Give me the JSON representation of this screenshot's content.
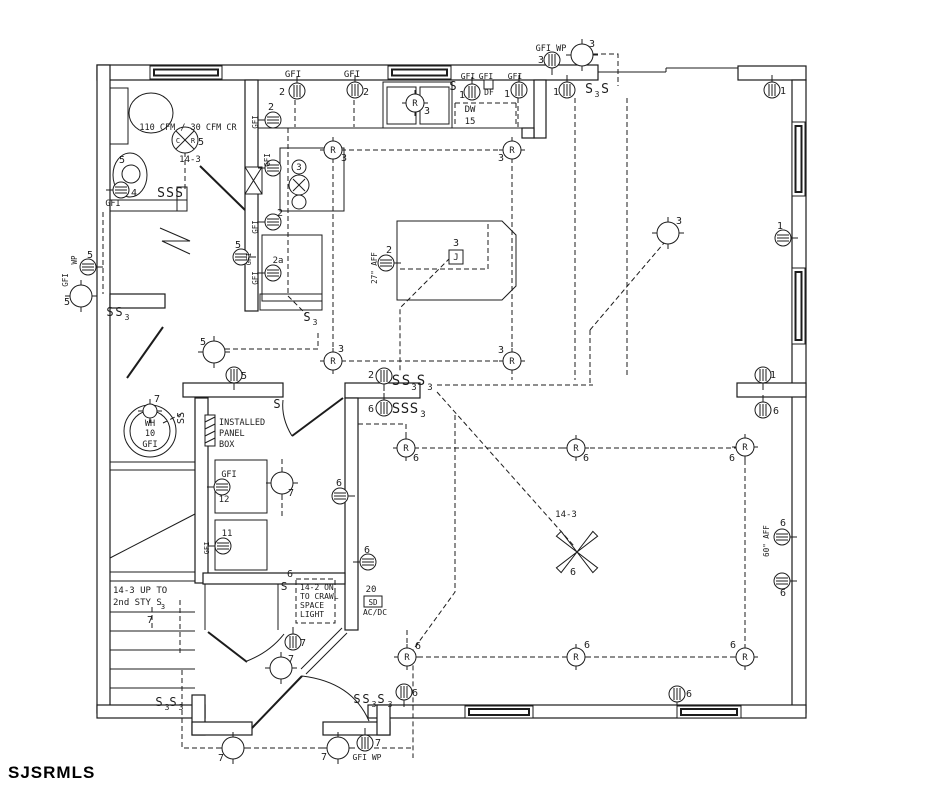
{
  "watermark": "SJSRMLS",
  "canvas": {
    "w": 939,
    "h": 788,
    "ink": "#1c1c1c",
    "bg": "#ffffff"
  },
  "plan": {
    "walls": [
      [
        97,
        65,
        501,
        15
      ],
      [
        738,
        66,
        68,
        14
      ],
      [
        792,
        80,
        14,
        633
      ],
      [
        97,
        65,
        13,
        648
      ],
      [
        97,
        705,
        108,
        13
      ],
      [
        368,
        705,
        438,
        13
      ],
      [
        192,
        695,
        13,
        40
      ],
      [
        192,
        722,
        60,
        13
      ],
      [
        323,
        722,
        67,
        13
      ],
      [
        377,
        705,
        13,
        30
      ],
      [
        245,
        80,
        13,
        231
      ],
      [
        110,
        294,
        55,
        14
      ],
      [
        183,
        383,
        100,
        14
      ],
      [
        345,
        383,
        75,
        15
      ],
      [
        345,
        398,
        13,
        232
      ],
      [
        195,
        398,
        13,
        185
      ],
      [
        203,
        573,
        142,
        11
      ],
      [
        737,
        383,
        69,
        14
      ],
      [
        534,
        80,
        12,
        58
      ],
      [
        522,
        128,
        12,
        10
      ]
    ],
    "windows": [
      [
        150,
        66,
        72,
        13
      ],
      [
        388,
        66,
        63,
        13
      ],
      [
        792,
        122,
        13,
        74
      ],
      [
        792,
        268,
        13,
        76
      ],
      [
        465,
        706,
        68,
        12
      ],
      [
        677,
        706,
        64,
        12
      ]
    ],
    "thin_lines": [
      [
        598,
        72,
        666,
        72
      ],
      [
        666,
        68,
        666,
        72
      ],
      [
        666,
        68,
        738,
        68
      ],
      [
        293,
        179,
        305,
        191
      ],
      [
        293,
        191,
        305,
        179
      ],
      [
        110,
        462,
        195,
        462
      ],
      [
        110,
        470,
        195,
        470
      ],
      [
        110,
        572,
        195,
        572
      ],
      [
        110,
        581,
        195,
        581
      ],
      [
        110,
        612,
        195,
        612
      ],
      [
        110,
        631,
        195,
        631
      ],
      [
        110,
        650,
        195,
        650
      ],
      [
        110,
        669,
        195,
        669
      ],
      [
        110,
        688,
        195,
        688
      ],
      [
        110,
        558,
        195,
        514
      ],
      [
        205,
        584,
        205,
        630
      ],
      [
        278,
        584,
        278,
        630
      ],
      [
        347,
        633,
        306,
        674
      ],
      [
        342,
        628,
        301,
        669
      ]
    ],
    "doors": [
      [
        245,
        210,
        200,
        166
      ],
      [
        127,
        378,
        163,
        327
      ],
      [
        343,
        398,
        292,
        436
      ],
      [
        208,
        632,
        247,
        662
      ],
      [
        252,
        728,
        302,
        676
      ]
    ],
    "arcs": [
      "M292,436 Q281,418 283,400",
      "M302,676 Q352,682 369,721",
      "M247,661 Q270,652 284,634"
    ],
    "zigzag": [
      160,
      228,
      190,
      241,
      162,
      241,
      190,
      254
    ],
    "island": [
      397,
      221,
      502,
      221,
      516,
      235,
      516,
      286,
      502,
      300,
      397,
      300
    ],
    "fixture_rects": [
      [
        258,
        80,
        276,
        48
      ],
      [
        280,
        148,
        64,
        63
      ],
      [
        262,
        235,
        60,
        66
      ],
      [
        260,
        294,
        62,
        16
      ],
      [
        383,
        82,
        69,
        46
      ],
      [
        387,
        87,
        29,
        37
      ],
      [
        420,
        87,
        29,
        37
      ],
      [
        110,
        88,
        18,
        56
      ],
      [
        110,
        200,
        77,
        11
      ],
      [
        177,
        187,
        10,
        24
      ],
      [
        215,
        460,
        52,
        53
      ],
      [
        215,
        520,
        52,
        50
      ]
    ],
    "fixture_circles": [
      [
        299,
        167,
        7
      ],
      [
        299,
        185,
        10
      ],
      [
        299,
        202,
        7
      ],
      [
        131,
        174,
        9
      ],
      [
        150,
        431,
        26
      ],
      [
        150,
        431,
        20
      ]
    ],
    "fixture_ellipses": [
      [
        151,
        113,
        22,
        20
      ],
      [
        130,
        175,
        17,
        22
      ]
    ],
    "dashed": [
      [
        185,
        152,
        185,
        192
      ],
      [
        103,
        212,
        103,
        294
      ],
      [
        295,
        100,
        295,
        127
      ],
      [
        354,
        100,
        354,
        127
      ],
      [
        518,
        98,
        518,
        127
      ],
      [
        455,
        103,
        516,
        103
      ],
      [
        455,
        103,
        455,
        127
      ],
      [
        516,
        103,
        516,
        127
      ],
      [
        288,
        128,
        288,
        296,
        306,
        314
      ],
      [
        333,
        150,
        512,
        150
      ],
      [
        333,
        150,
        333,
        361
      ],
      [
        512,
        150,
        512,
        361
      ],
      [
        333,
        361,
        512,
        361
      ],
      [
        512,
        361,
        512,
        380
      ],
      [
        450,
        258,
        400,
        308,
        400,
        372
      ],
      [
        400,
        269,
        488,
        269,
        488,
        224
      ],
      [
        593,
        54,
        618,
        54,
        618,
        86
      ],
      [
        575,
        98,
        575,
        380
      ],
      [
        627,
        98,
        627,
        375
      ],
      [
        590,
        330,
        590,
        383
      ],
      [
        590,
        330,
        664,
        243
      ],
      [
        437,
        385,
        593,
        385
      ],
      [
        437,
        392,
        574,
        546
      ],
      [
        225,
        349,
        318,
        349,
        318,
        332
      ],
      [
        358,
        424,
        406,
        424,
        406,
        448
      ],
      [
        406,
        448,
        737,
        448
      ],
      [
        745,
        460,
        745,
        645
      ],
      [
        418,
        657,
        733,
        657
      ],
      [
        407,
        630,
        407,
        648
      ],
      [
        455,
        415,
        455,
        592,
        413,
        650,
        413,
        758
      ],
      [
        182,
        670,
        182,
        748,
        221,
        748
      ],
      [
        246,
        748,
        326,
        748
      ],
      [
        350,
        748,
        413,
        748
      ],
      [
        296,
        579,
        335,
        579,
        335,
        623,
        296,
        623,
        296,
        579
      ],
      [
        282,
        459,
        282,
        471
      ],
      [
        282,
        495,
        282,
        516
      ],
      [
        152,
        607,
        152,
        630
      ],
      [
        180,
        600,
        180,
        656
      ],
      [
        163,
        423,
        181,
        414
      ]
    ],
    "receptacles": [
      [
        297,
        91,
        0
      ],
      [
        355,
        90,
        0
      ],
      [
        472,
        92,
        0
      ],
      [
        519,
        90,
        0
      ],
      [
        567,
        90,
        0
      ],
      [
        552,
        60,
        180
      ],
      [
        772,
        90,
        0
      ],
      [
        783,
        238,
        90
      ],
      [
        273,
        120,
        270
      ],
      [
        273,
        168,
        270
      ],
      [
        273,
        222,
        270
      ],
      [
        241,
        257,
        90
      ],
      [
        273,
        273,
        270
      ],
      [
        386,
        263,
        90
      ],
      [
        88,
        267,
        90
      ],
      [
        234,
        375,
        180
      ],
      [
        384,
        376,
        180
      ],
      [
        384,
        408,
        0
      ],
      [
        340,
        496,
        90
      ],
      [
        368,
        562,
        270
      ],
      [
        222,
        487,
        270
      ],
      [
        223,
        546,
        270
      ],
      [
        293,
        642,
        0
      ],
      [
        404,
        692,
        180
      ],
      [
        677,
        694,
        180
      ],
      [
        763,
        375,
        180
      ],
      [
        763,
        410,
        0
      ],
      [
        782,
        537,
        90
      ],
      [
        782,
        581,
        90
      ],
      [
        365,
        743,
        0
      ],
      [
        121,
        190,
        270
      ]
    ],
    "lights": [
      [
        582,
        55,
        11
      ],
      [
        668,
        233,
        11
      ],
      [
        81,
        296,
        11
      ],
      [
        214,
        352,
        11
      ],
      [
        282,
        483,
        11
      ],
      [
        281,
        668,
        11
      ],
      [
        233,
        748,
        11
      ],
      [
        338,
        748,
        11
      ],
      [
        150,
        411,
        7
      ]
    ],
    "recessed_lights": [
      [
        333,
        150
      ],
      [
        512,
        150
      ],
      [
        333,
        361
      ],
      [
        512,
        361
      ],
      [
        406,
        448
      ],
      [
        576,
        448
      ],
      [
        745,
        447
      ],
      [
        407,
        657
      ],
      [
        576,
        657
      ],
      [
        745,
        657
      ],
      [
        415,
        103
      ]
    ],
    "fan_light": [
      185,
      140
    ],
    "ceiling_fan": [
      577,
      552
    ],
    "junction_box": [
      456,
      257
    ],
    "smoke_detector": [
      373,
      602
    ],
    "chase": [
      245,
      167,
      17,
      27
    ],
    "panel_box": [
      205,
      415,
      10,
      31
    ],
    "df_box": [
      484,
      80,
      9,
      9
    ],
    "texts": [
      [
        551,
        51,
        "GFI WP",
        8.5
      ],
      [
        541,
        63,
        "3"
      ],
      [
        592,
        47,
        "3"
      ],
      [
        293,
        77,
        "GFI",
        9
      ],
      [
        282,
        95,
        "2"
      ],
      [
        352,
        77,
        "GFI",
        9
      ],
      [
        366,
        95,
        "2"
      ],
      [
        468,
        79,
        "GFI",
        8
      ],
      [
        486,
        79,
        "GFI",
        8
      ],
      [
        515,
        79,
        "GFI",
        8
      ],
      [
        462,
        98,
        "1"
      ],
      [
        507,
        97,
        "1"
      ],
      [
        556,
        95,
        "1"
      ],
      [
        489,
        95,
        "DF",
        8
      ],
      [
        453,
        90,
        "S",
        12
      ],
      [
        470,
        112,
        "DW",
        9
      ],
      [
        470,
        124,
        "15",
        9
      ],
      [
        427,
        114,
        "3"
      ],
      [
        589,
        93,
        "S",
        13
      ],
      [
        597,
        97,
        "3",
        8
      ],
      [
        605,
        93,
        "S",
        13
      ],
      [
        783,
        94,
        "1"
      ],
      [
        780,
        229,
        "1"
      ],
      [
        679,
        224,
        "3"
      ],
      [
        344,
        161,
        "3"
      ],
      [
        501,
        161,
        "3"
      ],
      [
        341,
        352,
        "3"
      ],
      [
        501,
        353,
        "3"
      ],
      [
        188,
        130,
        "110 CFM / 30 CFM CR",
        8.5
      ],
      [
        201,
        145,
        "5"
      ],
      [
        190,
        162,
        "14-3",
        9
      ],
      [
        122,
        163,
        "5"
      ],
      [
        134,
        196,
        "4"
      ],
      [
        113,
        206,
        "GFI",
        8.5
      ],
      [
        161,
        197,
        "S",
        13
      ],
      [
        170,
        197,
        "S",
        13
      ],
      [
        179,
        197,
        "S",
        13
      ],
      [
        271,
        110,
        "2"
      ],
      [
        258,
        122,
        "GFI",
        7.5,
        -90
      ],
      [
        280,
        216,
        "2"
      ],
      [
        258,
        227,
        "GFI",
        7.5,
        -90
      ],
      [
        270,
        160,
        "GFI",
        7.5,
        -90
      ],
      [
        299,
        170,
        "3",
        9
      ],
      [
        238,
        248,
        "5"
      ],
      [
        251,
        259,
        "GFI",
        7,
        -90
      ],
      [
        278,
        263,
        "2a",
        9
      ],
      [
        258,
        278,
        "GFI",
        7.5,
        -90
      ],
      [
        307,
        321,
        "S",
        12
      ],
      [
        315,
        325,
        "3",
        8
      ],
      [
        456,
        246,
        "3"
      ],
      [
        389,
        253,
        "2"
      ],
      [
        377,
        268,
        "27\" AFF",
        7.5,
        -90
      ],
      [
        90,
        258,
        "5"
      ],
      [
        77,
        260,
        "WP",
        7.5,
        -90
      ],
      [
        68,
        280,
        "GFI",
        7.5,
        -90
      ],
      [
        67,
        305,
        "5"
      ],
      [
        110,
        316,
        "S",
        12
      ],
      [
        119,
        316,
        "S",
        12
      ],
      [
        127,
        320,
        "3",
        8
      ],
      [
        203,
        345,
        "5"
      ],
      [
        244,
        379,
        "5"
      ],
      [
        277,
        408,
        "S",
        12
      ],
      [
        184,
        418,
        "SS",
        10,
        -90
      ],
      [
        219,
        425,
        "INSTALLED",
        8.5,
        0,
        "start"
      ],
      [
        219,
        436,
        "PANEL",
        8.5,
        0,
        "start"
      ],
      [
        219,
        447,
        "BOX",
        8.5,
        0,
        "start"
      ],
      [
        150,
        426,
        "WH",
        8.5
      ],
      [
        150,
        436,
        "10",
        8.5
      ],
      [
        150,
        447,
        "GFI",
        8.5
      ],
      [
        157,
        402,
        "7"
      ],
      [
        229,
        477,
        "GFI",
        8.5
      ],
      [
        224,
        502,
        "12",
        9
      ],
      [
        227,
        536,
        "11",
        9
      ],
      [
        209,
        548,
        "GFI",
        7,
        -90
      ],
      [
        291,
        496,
        "7"
      ],
      [
        339,
        486,
        "6"
      ],
      [
        367,
        553,
        "6"
      ],
      [
        371,
        378,
        "2"
      ],
      [
        396,
        385,
        "S",
        14
      ],
      [
        406,
        385,
        "S",
        14
      ],
      [
        414,
        390,
        "3",
        9
      ],
      [
        421,
        385,
        "S",
        14
      ],
      [
        430,
        390,
        "3",
        9
      ],
      [
        371,
        412,
        "6"
      ],
      [
        396,
        413,
        "S",
        14
      ],
      [
        405,
        413,
        "S",
        14
      ],
      [
        414,
        413,
        "S",
        14
      ],
      [
        423,
        417,
        "3",
        9
      ],
      [
        416,
        461,
        "6"
      ],
      [
        586,
        461,
        "6"
      ],
      [
        732,
        461,
        "6"
      ],
      [
        418,
        649,
        "6"
      ],
      [
        587,
        648,
        "6"
      ],
      [
        733,
        648,
        "6"
      ],
      [
        773,
        378,
        "1"
      ],
      [
        776,
        414,
        "6"
      ],
      [
        783,
        526,
        "6"
      ],
      [
        769,
        541,
        "60\" AFF",
        7.5,
        -90
      ],
      [
        783,
        596,
        "6"
      ],
      [
        566,
        517,
        "14-3",
        9
      ],
      [
        573,
        575,
        "6"
      ],
      [
        113,
        593,
        "14-3 UP TO",
        9,
        0,
        "start"
      ],
      [
        113,
        605,
        "2nd STY S",
        9,
        0,
        "start"
      ],
      [
        163,
        609,
        "3",
        7
      ],
      [
        150,
        623,
        "7"
      ],
      [
        290,
        577,
        "6"
      ],
      [
        284,
        590,
        "S",
        11
      ],
      [
        300,
        590,
        "14-2 ON",
        8,
        0,
        "start"
      ],
      [
        300,
        599,
        "TO CRAWL",
        8,
        0,
        "start"
      ],
      [
        300,
        608,
        "SPACE",
        8,
        0,
        "start"
      ],
      [
        300,
        617,
        "LIGHT",
        8,
        0,
        "start"
      ],
      [
        371,
        592,
        "20",
        9
      ],
      [
        375,
        615,
        "AC/DC",
        8
      ],
      [
        303,
        646,
        "7"
      ],
      [
        291,
        662,
        "7"
      ],
      [
        159,
        706,
        "S",
        12
      ],
      [
        167,
        710,
        "3",
        8
      ],
      [
        173,
        706,
        "S",
        12
      ],
      [
        181,
        710,
        "3",
        8
      ],
      [
        357,
        703,
        "S",
        12
      ],
      [
        366,
        703,
        "S",
        12
      ],
      [
        374,
        707,
        "3",
        8
      ],
      [
        381,
        703,
        "S",
        12
      ],
      [
        390,
        707,
        "3",
        8
      ],
      [
        415,
        696,
        "6"
      ],
      [
        689,
        697,
        "6"
      ],
      [
        221,
        761,
        "7"
      ],
      [
        324,
        760,
        "7"
      ],
      [
        378,
        746,
        "7"
      ],
      [
        367,
        760,
        "GFI WP",
        8
      ]
    ]
  }
}
